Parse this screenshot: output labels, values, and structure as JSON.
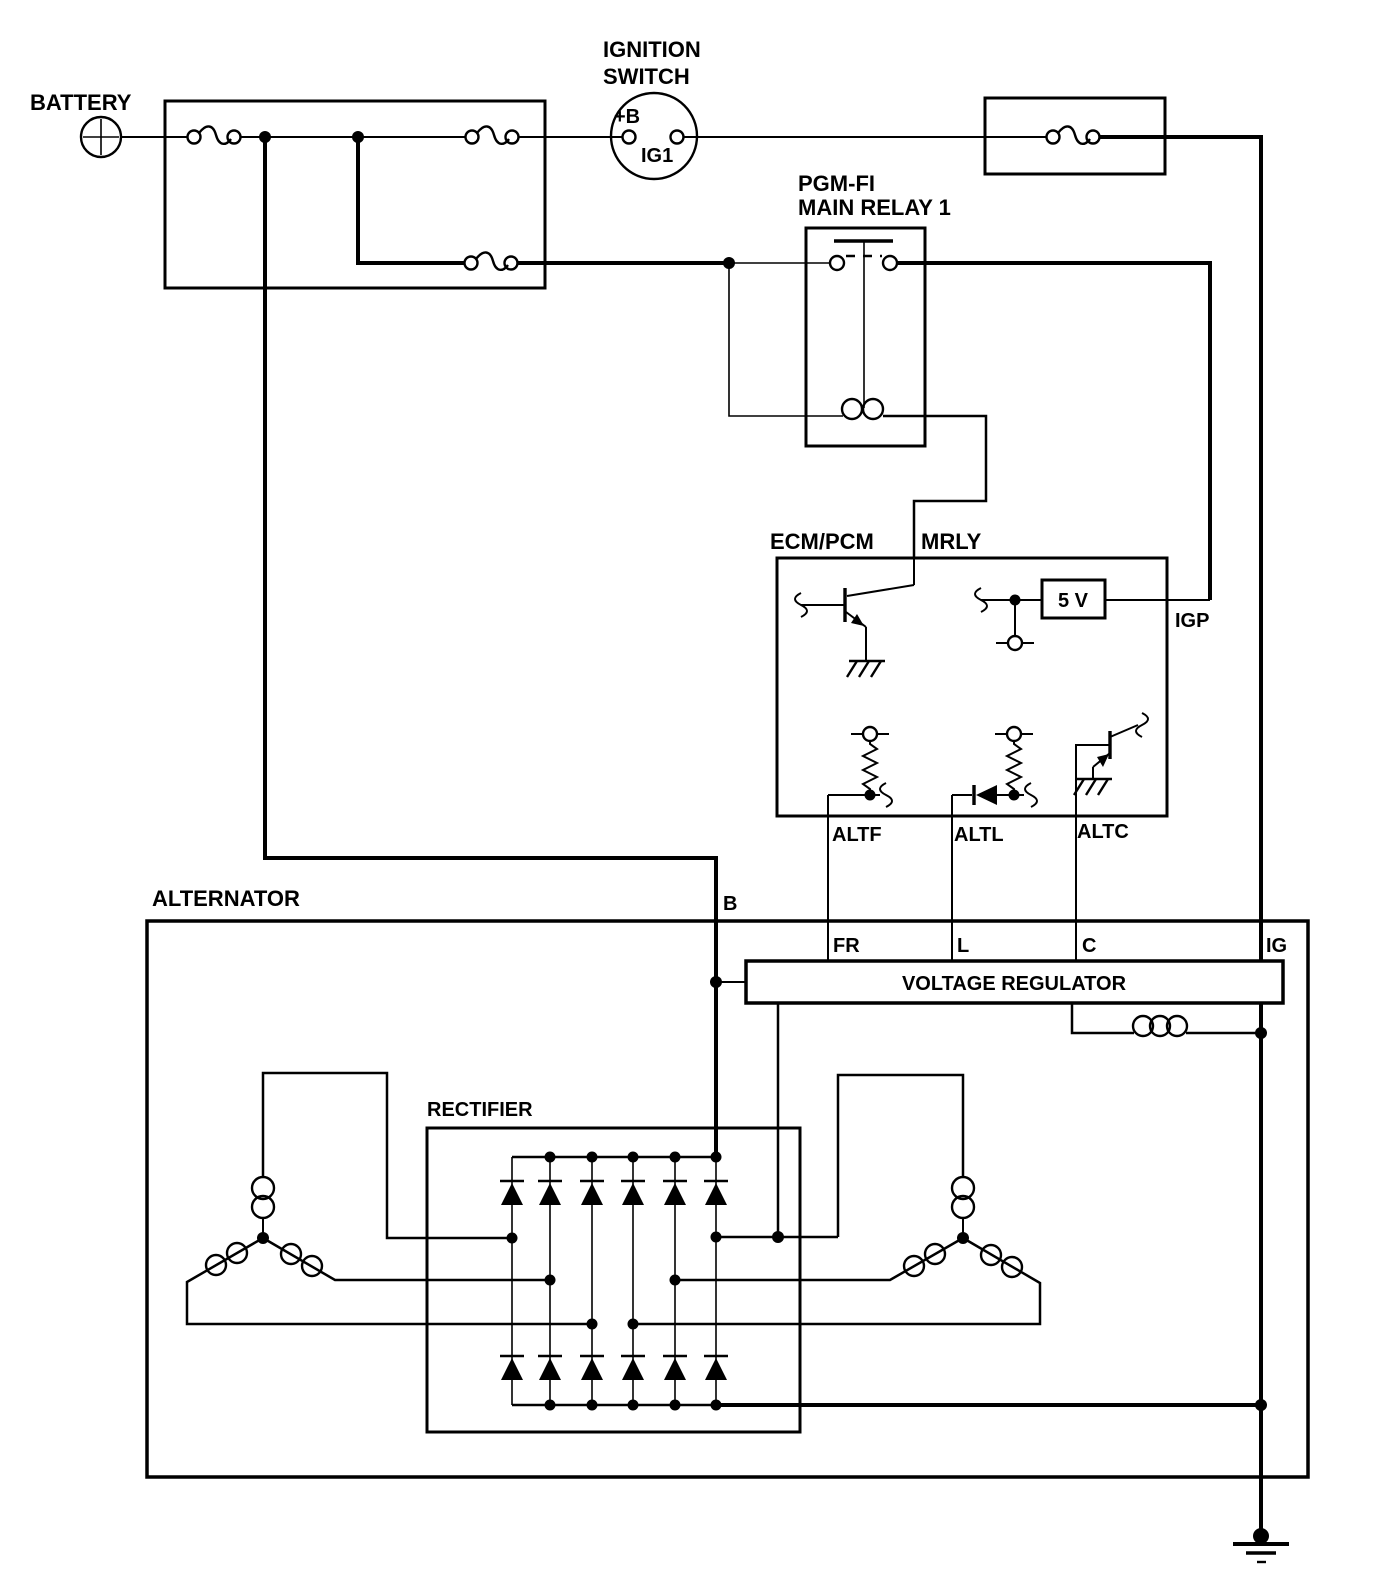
{
  "colors": {
    "ink": "#000000",
    "background": "#ffffff"
  },
  "labels": {
    "battery": "BATTERY",
    "ignition_switch_line1": "IGNITION",
    "ignition_switch_line2": "SWITCH",
    "ignition_terminal_b": "+B",
    "ignition_terminal_ig1": "IG1",
    "relay_line1": "PGM-FI",
    "relay_line2": "MAIN RELAY 1",
    "ecm": "ECM/PCM",
    "mrly": "MRLY",
    "five_volt": "5 V",
    "igp": "IGP",
    "altf": "ALTF",
    "altl": "ALTL",
    "altc": "ALTC",
    "alternator": "ALTERNATOR",
    "terminal_b": "B",
    "terminal_fr": "FR",
    "terminal_l": "L",
    "terminal_c": "C",
    "terminal_ig": "IG",
    "voltage_regulator": "VOLTAGE REGULATOR",
    "rectifier": "RECTIFIER"
  }
}
